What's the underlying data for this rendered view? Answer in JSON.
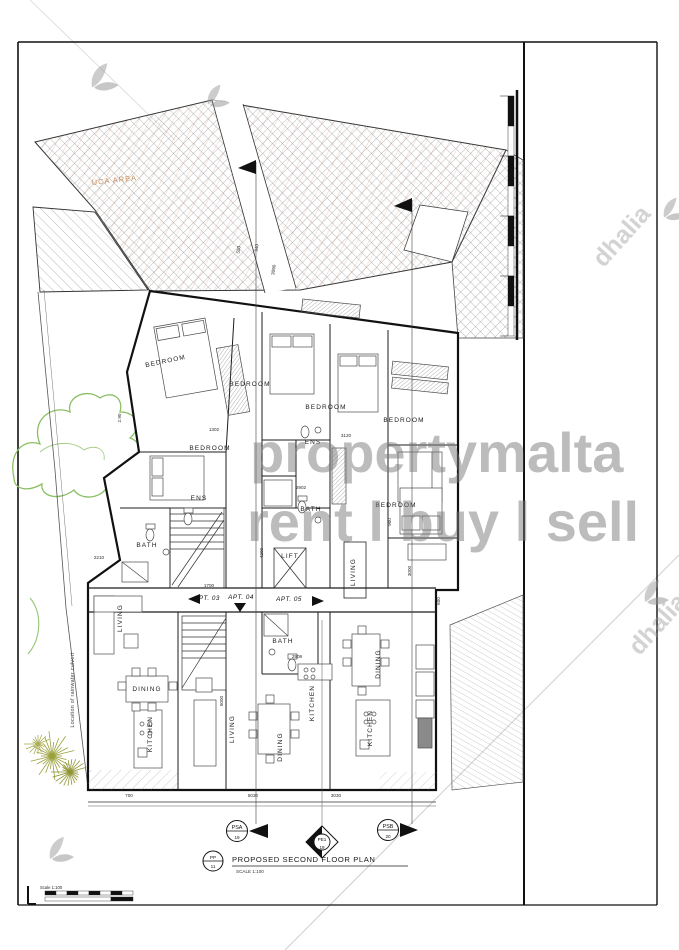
{
  "watermark": {
    "line1": "propertymalta",
    "line2": "rent l buy l sell",
    "brand": "dhalia"
  },
  "annotations": {
    "uca": "UCA AREA",
    "culvert": "Location of rainwater culvert"
  },
  "title_block": {
    "ref_top": "PP",
    "ref_bottom": "11",
    "title": "PROPOSED SECOND FLOOR PLAN",
    "scale": "SCALE 1:100"
  },
  "scale_bar": {
    "label": "Scale 1:100"
  },
  "section_markers": {
    "psa": {
      "top": "PSA",
      "bottom": "19"
    },
    "pe1": {
      "top": "PE1",
      "bottom": "19"
    },
    "psb": {
      "top": "PSB",
      "bottom": "20"
    }
  },
  "apartments": [
    {
      "label": "APT. 03",
      "x": 207,
      "y": 600
    },
    {
      "label": "APT. 04",
      "x": 241,
      "y": 599
    },
    {
      "label": "APT. 05",
      "x": 289,
      "y": 601
    }
  ],
  "rooms": [
    {
      "label": "BEDROOM",
      "x": 166,
      "y": 363,
      "rot": -12
    },
    {
      "label": "BEDROOM",
      "x": 250,
      "y": 386,
      "rot": 0
    },
    {
      "label": "BEDROOM",
      "x": 326,
      "y": 409,
      "rot": 0
    },
    {
      "label": "BEDROOM",
      "x": 404,
      "y": 422,
      "rot": 0
    },
    {
      "label": "BEDROOM",
      "x": 210,
      "y": 450,
      "rot": 0
    },
    {
      "label": "BEDROOM",
      "x": 396,
      "y": 507,
      "rot": 0
    },
    {
      "label": "ENS",
      "x": 313,
      "y": 444,
      "rot": 0
    },
    {
      "label": "ENS",
      "x": 199,
      "y": 500,
      "rot": 0
    },
    {
      "label": "BATH",
      "x": 147,
      "y": 547,
      "rot": 0
    },
    {
      "label": "BATH",
      "x": 311,
      "y": 511,
      "rot": 0
    },
    {
      "label": "BATH",
      "x": 283,
      "y": 643,
      "rot": 0
    },
    {
      "label": "LIFT",
      "x": 290,
      "y": 558,
      "rot": 0
    },
    {
      "label": "LIVING",
      "x": 122,
      "y": 618,
      "rot": -90
    },
    {
      "label": "DINING",
      "x": 147,
      "y": 691,
      "rot": 0
    },
    {
      "label": "KITCHEN",
      "x": 152,
      "y": 734,
      "rot": -90
    },
    {
      "label": "LIVING",
      "x": 234,
      "y": 729,
      "rot": -90
    },
    {
      "label": "DINING",
      "x": 282,
      "y": 747,
      "rot": -90
    },
    {
      "label": "KITCHEN",
      "x": 314,
      "y": 703,
      "rot": -90
    },
    {
      "label": "LIVING",
      "x": 355,
      "y": 572,
      "rot": -90
    },
    {
      "label": "DINING",
      "x": 380,
      "y": 664,
      "rot": -90
    },
    {
      "label": "KITCHEN",
      "x": 372,
      "y": 728,
      "rot": -90
    }
  ],
  "dimensions": [
    {
      "t": "2.90",
      "x": 121,
      "y": 418,
      "r": -90
    },
    {
      "t": "1302",
      "x": 214,
      "y": 431,
      "r": 0
    },
    {
      "t": "3120",
      "x": 346,
      "y": 437,
      "r": 0
    },
    {
      "t": "2902",
      "x": 301,
      "y": 489,
      "r": 0
    },
    {
      "t": "900",
      "x": 391,
      "y": 522,
      "r": -90
    },
    {
      "t": "2210",
      "x": 99,
      "y": 559,
      "r": 0
    },
    {
      "t": "1700",
      "x": 209,
      "y": 587,
      "r": 0
    },
    {
      "t": "2908",
      "x": 297,
      "y": 658,
      "r": 0
    },
    {
      "t": "4200",
      "x": 263,
      "y": 553,
      "r": -90
    },
    {
      "t": "3000",
      "x": 411,
      "y": 571,
      "r": -90
    },
    {
      "t": "5000",
      "x": 223,
      "y": 701,
      "r": -90
    },
    {
      "t": "600",
      "x": 440,
      "y": 601,
      "r": -90
    },
    {
      "t": "5030",
      "x": 253,
      "y": 797,
      "r": 0
    },
    {
      "t": "3030",
      "x": 336,
      "y": 797,
      "r": 0
    },
    {
      "t": "700",
      "x": 129,
      "y": 797,
      "r": 0
    },
    {
      "t": "3090",
      "x": 275,
      "y": 270,
      "r": -82
    },
    {
      "t": "550",
      "x": 240,
      "y": 250,
      "r": -82
    },
    {
      "t": "940",
      "x": 258,
      "y": 248,
      "r": -82
    }
  ]
}
